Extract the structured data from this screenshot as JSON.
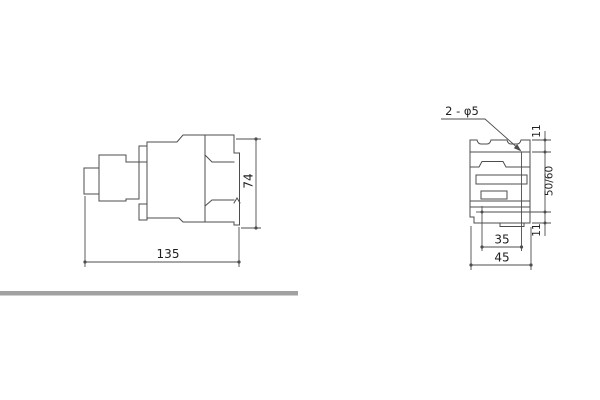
{
  "drawing": {
    "side_view": {
      "label_length": "135",
      "label_height": "74"
    },
    "front_view": {
      "hole_callout": "2 - φ5",
      "label_top_offset": "11",
      "label_rail_span": "50/60",
      "label_bottom_offset": "11",
      "label_hole_spacing": "35",
      "label_width": "45"
    }
  },
  "colors": {
    "divider": "#a1a1a1",
    "line": "#4d4d4d",
    "text": "#1f1f1f"
  }
}
